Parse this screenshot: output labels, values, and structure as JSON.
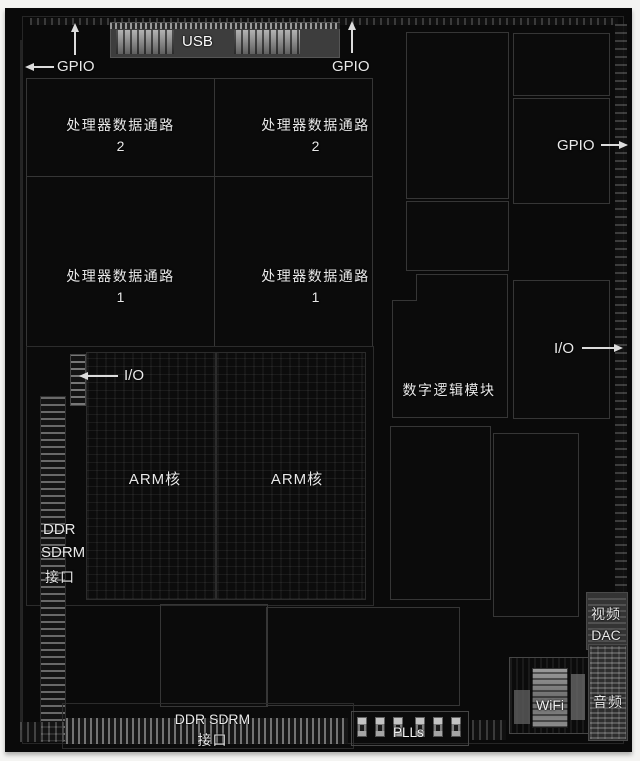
{
  "labels": {
    "gpio": "GPIO",
    "usb": "USB",
    "io": "I/O",
    "datapath": "处理器数据通路",
    "datapath2_num": "2",
    "datapath1_num": "1",
    "digital_logic": "数字逻辑模块",
    "arm_core": "ARM核",
    "ddr_left": {
      "l1": "DDR",
      "l2": "SDRM",
      "l3": "接口"
    },
    "video_dac": {
      "l1": "视频",
      "l2": "DAC"
    },
    "wifi": "WiFi",
    "audio": "音频",
    "ddr_bottom": {
      "l1": "DDR SDRM",
      "l2": "接口"
    },
    "plls": "PLLs"
  },
  "colors": {
    "page_bg": "#f4f4f2",
    "die_bg": "#0a0a0a",
    "block_outline": "#363636",
    "annotation_text": "#e9e9e9",
    "pad_bright": "#8d8d8d"
  }
}
